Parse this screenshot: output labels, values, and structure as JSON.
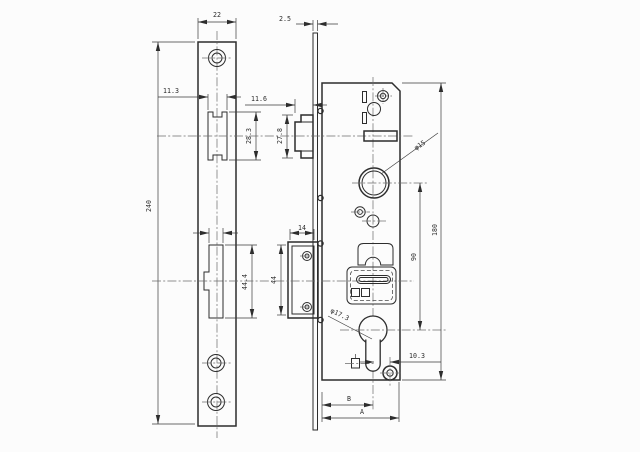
{
  "drawing": {
    "type": "engineering-drawing",
    "subject": "narrow-stile mortise lock case with faceplate, three orthographic views",
    "colors": {
      "line": "#2d2d2d",
      "centerline": "#6b6b6b",
      "background": "#fcfcfc"
    },
    "dims": {
      "faceplate_width": "22",
      "plate_thickness": "2.5",
      "latch_opening_width": "11.3",
      "latch_projection": "11.6",
      "latch_opening_height": "28.3",
      "latch_height": "27.8",
      "faceplate_length": "240",
      "deadbolt_opening_height": "44.4",
      "strike_box_width": "14",
      "strike_box_height": "44",
      "follower_diameter": "φ15",
      "case_height": "180",
      "centre_distance": "90",
      "cylinder_diameter": "φ17.3",
      "post_offset": "10.3",
      "backset_label": "B",
      "case_depth_label": "A"
    }
  }
}
